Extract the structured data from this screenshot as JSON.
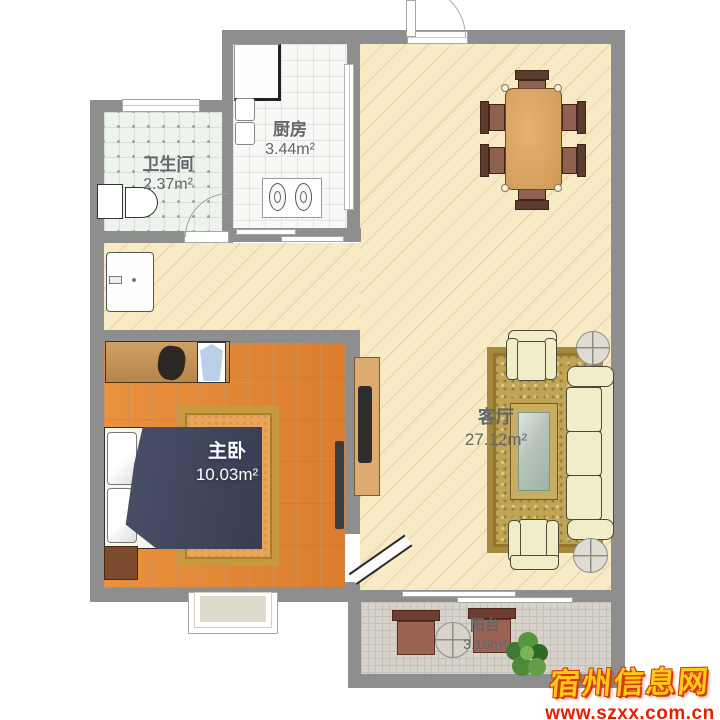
{
  "rooms": {
    "bathroom": {
      "name": "卫生间",
      "area": "2.37m²"
    },
    "kitchen": {
      "name": "厨房",
      "area": "3.44m²"
    },
    "bedroom": {
      "name": "主卧",
      "area": "10.03m²"
    },
    "living_room": {
      "name": "客厅",
      "area": "27.12m²"
    },
    "balcony": {
      "name": "阳台",
      "area": "3.16m²"
    }
  },
  "watermark": {
    "site_name": "宿州信息网",
    "site_url": "www.szxx.com.cn"
  },
  "colors": {
    "wall": "#8e8e8e",
    "living_floor": "#f7eac5",
    "bedroom_floor": "#e18a3b",
    "kitchen_floor": "#f8f8f6",
    "bathroom_floor": "#eef3ed",
    "balcony_floor": "#d7d3ca",
    "rug_gold": "#bfa455",
    "sofa_cream": "#f2edc9",
    "bed_blanket": "#3d4257",
    "watermark_yellow": "#ffc719",
    "watermark_red": "#e81e00"
  }
}
